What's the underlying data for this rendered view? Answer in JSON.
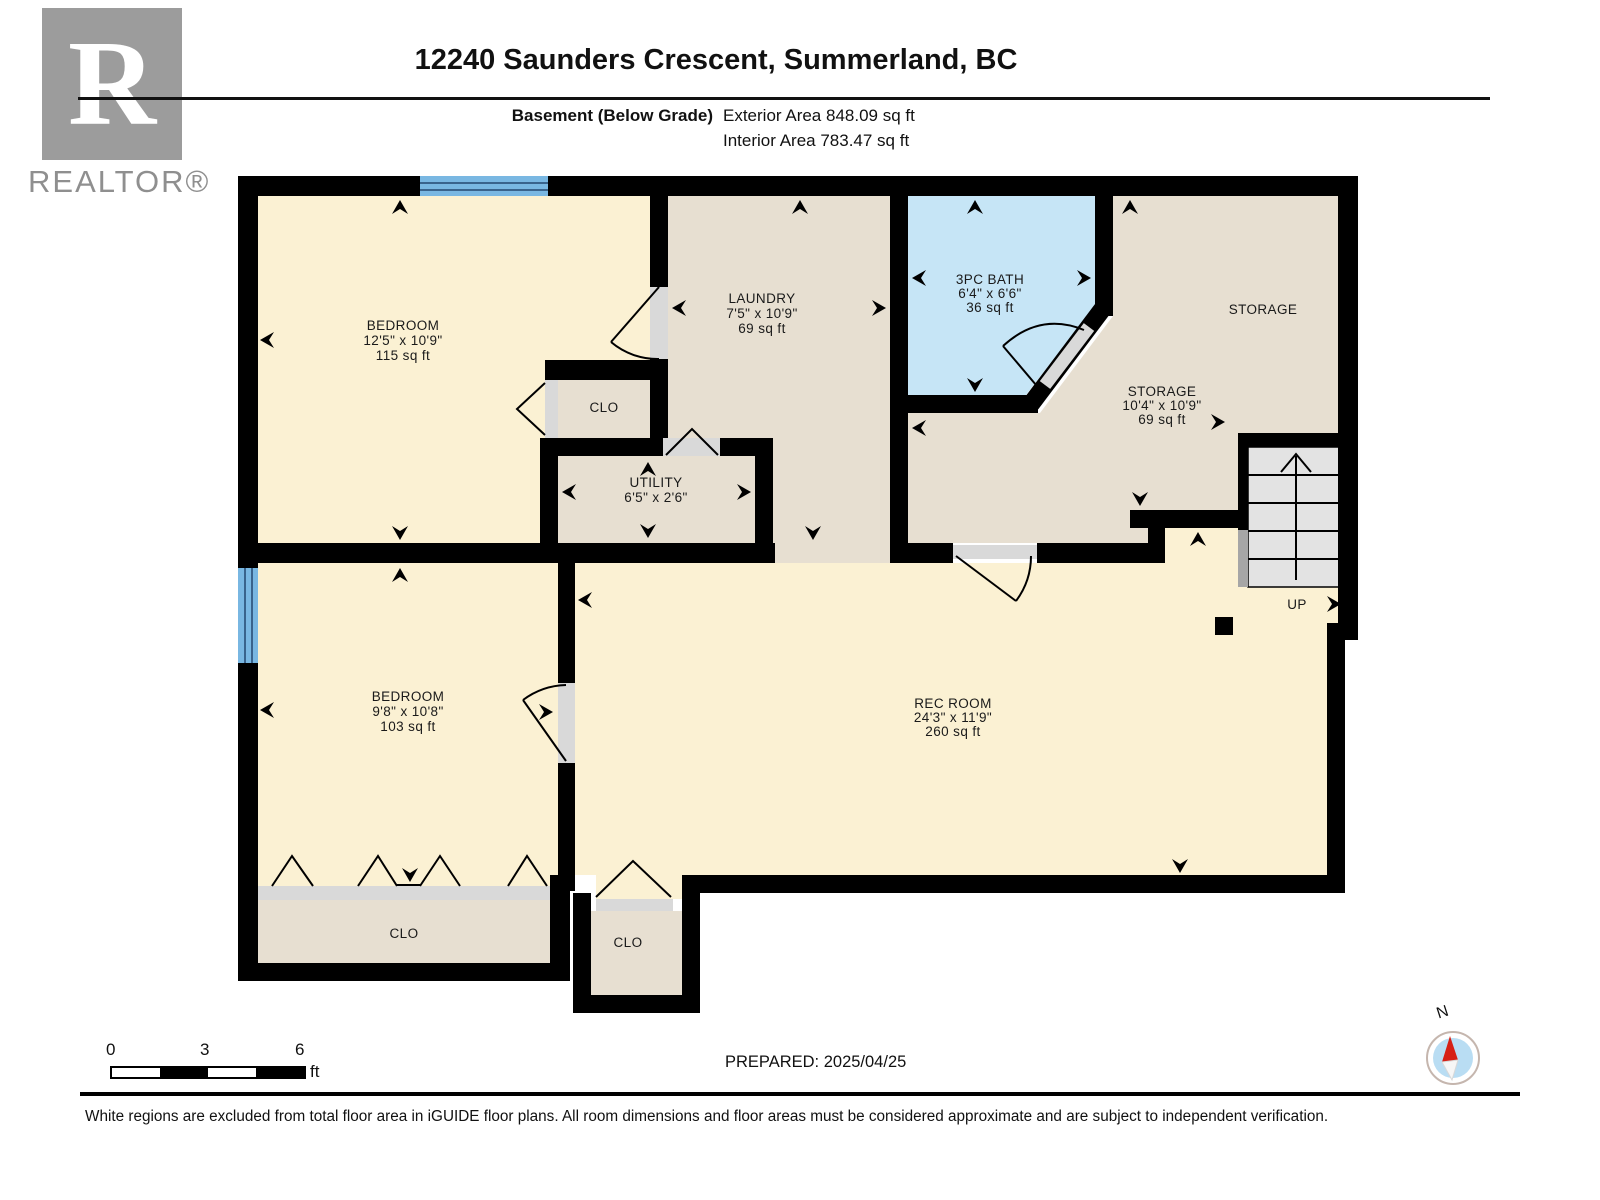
{
  "header": {
    "logo_letter": "R",
    "logo_text": "REALTOR®",
    "title": "12240 Saunders Crescent, Summerland, BC",
    "floor_label": "Basement (Below Grade)",
    "exterior_area": "Exterior Area 848.09 sq ft",
    "interior_area": "Interior Area 783.47 sq ft"
  },
  "plan": {
    "rooms": {
      "bedroom1": {
        "name": "BEDROOM",
        "dims": "12'5\" x 10'9\"",
        "area": "115 sq ft"
      },
      "laundry": {
        "name": "LAUNDRY",
        "dims": "7'5\" x 10'9\"",
        "area": "69 sq ft"
      },
      "bath": {
        "name": "3PC BATH",
        "dims": "6'4\" x 6'6\"",
        "area": "36 sq ft"
      },
      "storage_main": {
        "name": "STORAGE"
      },
      "storage_small": {
        "name": "STORAGE",
        "dims": "10'4\" x 10'9\"",
        "area": "69 sq ft"
      },
      "closet_hall": {
        "name": "CLO"
      },
      "utility": {
        "name": "UTILITY",
        "dims": "6'5\" x 2'6\""
      },
      "bedroom2": {
        "name": "BEDROOM",
        "dims": "9'8\" x 10'8\"",
        "area": "103 sq ft"
      },
      "rec_room": {
        "name": "REC ROOM",
        "dims": "24'3\" x 11'9\"",
        "area": "260 sq ft"
      },
      "closet_bedroom2": {
        "name": "CLO"
      },
      "closet_rec": {
        "name": "CLO"
      },
      "stairs_label": "UP"
    },
    "colors": {
      "room_cream": "#FBF1D3",
      "room_tan": "#E7DFD1",
      "bath_blue": "#C6E5F6",
      "window_blue": "#79B7E2",
      "wall_black": "#000000",
      "opening_gray": "#D9D9D9"
    }
  },
  "scale_bar": {
    "tick_0": "0",
    "tick_3": "3",
    "tick_6": "6",
    "unit": "ft"
  },
  "prepared": "PREPARED: 2025/04/25",
  "compass": {
    "north_label": "N"
  },
  "footer": "White regions are excluded from total floor area in iGUIDE floor plans. All room dimensions and floor areas must be considered approximate and are subject to independent verification."
}
